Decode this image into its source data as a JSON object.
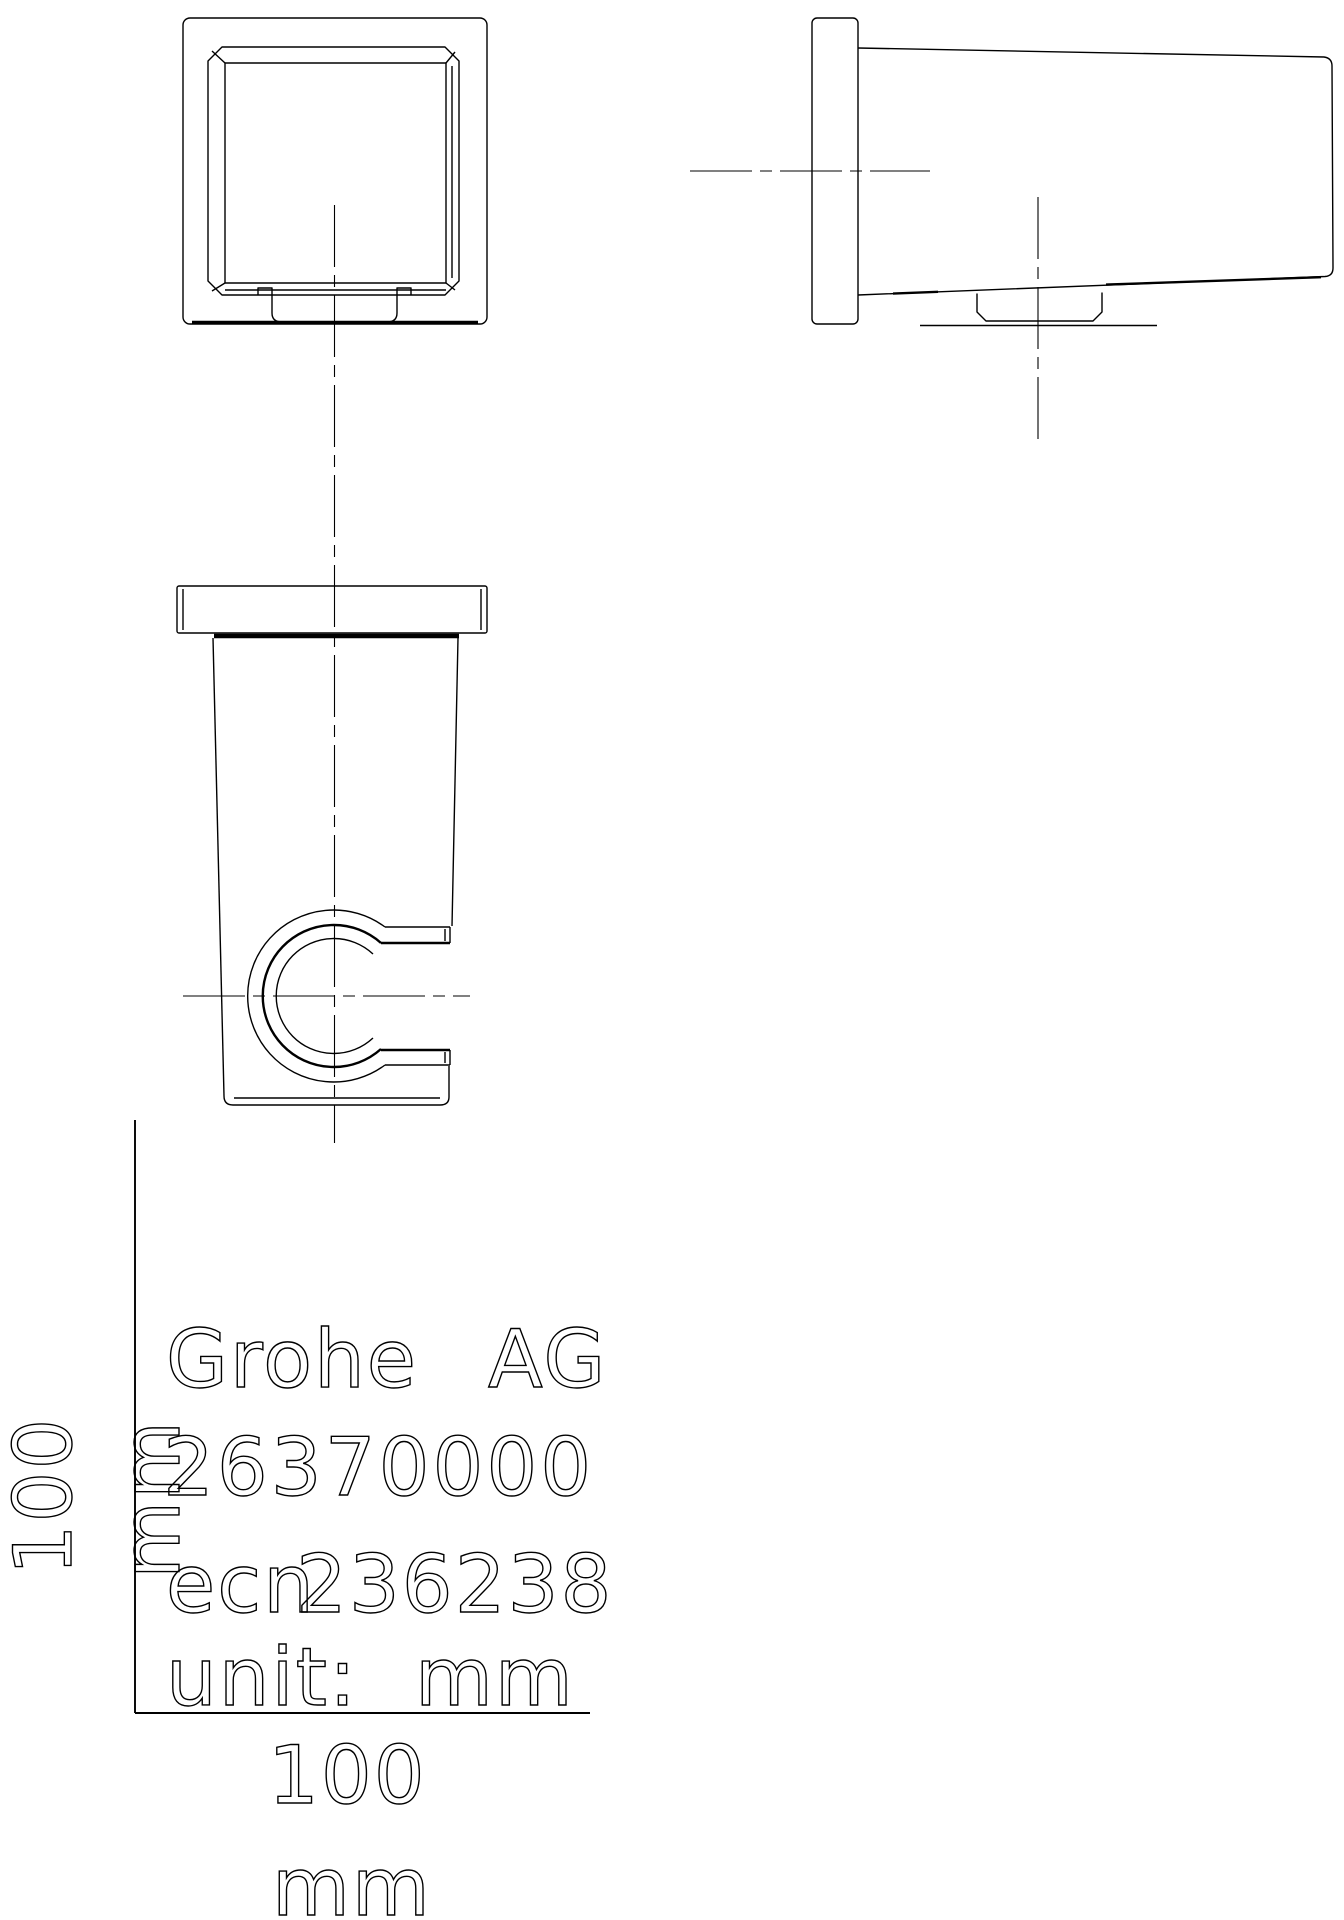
{
  "colors": {
    "line": "#000000",
    "background": "#ffffff"
  },
  "title_block": {
    "manufacturer": "Grohe AG",
    "manufacturer_word1": "Grohe",
    "manufacturer_word2": "AG",
    "product_number": "26370000",
    "ecn_label": "ecn",
    "ecn_number": "236238",
    "unit_label": "unit:",
    "unit_value": "mm"
  },
  "dimensions": {
    "height_value": "100",
    "height_unit": "mm",
    "width_value": "100",
    "width_unit": "mm"
  }
}
